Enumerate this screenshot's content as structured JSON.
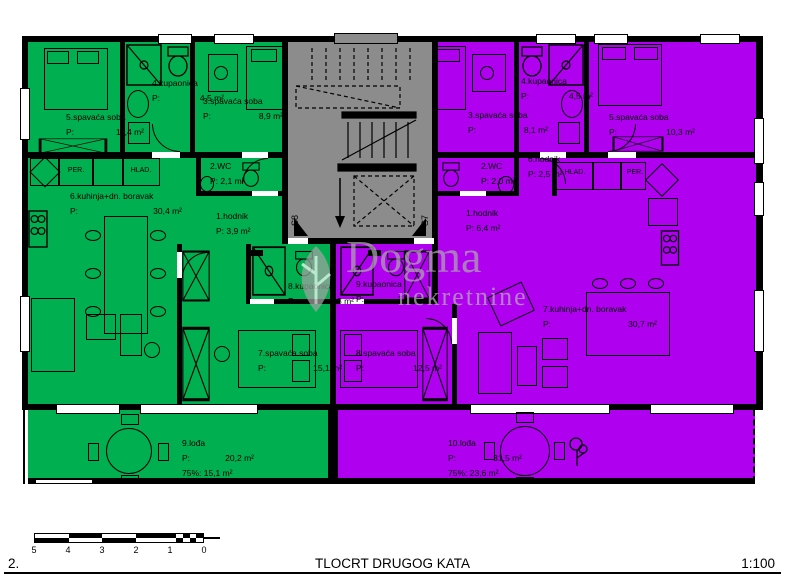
{
  "colors": {
    "green": "#00b050",
    "purple": "#b000f0",
    "gray": "#8c8c8c",
    "wall": "#000000"
  },
  "watermark": {
    "brand": "Dogma",
    "subtitle": "nekretnine"
  },
  "core": {
    "left_door": "S8",
    "right_door": "S7"
  },
  "left": {
    "bedroom5": {
      "name": "5.spavaća soba",
      "p": "P:",
      "area": "11,4 m²"
    },
    "bathroom4": {
      "name": "4.kupaonica",
      "p": "P:",
      "area": "4,5 m²"
    },
    "bedroom3": {
      "name": "3.spavaća soba",
      "p": "P:",
      "area": "8,9 m²"
    },
    "wc2": {
      "name": "2.WC",
      "area": "P: 2,1 m²"
    },
    "hodnik1": {
      "name": "1.hodnik",
      "area": "P: 3,9 m²"
    },
    "kitchen6": {
      "name": "6.kuhinja+dn. boravak",
      "p": "P:",
      "area": "30,4 m²"
    },
    "bedroom7": {
      "name": "7.spavaća soba",
      "p": "P:",
      "area": "15,1 m²"
    },
    "bathroom8": {
      "name": "8.kupaonica",
      "p": "P:",
      "area": "3,8 m²"
    },
    "loggia9": {
      "name": "9.lođa",
      "p": "P:",
      "area": "20,2 m²",
      "area75": "75%: 15,1 m²"
    },
    "washer": "PER.",
    "fridge": "HLAD."
  },
  "right": {
    "bedroom3": {
      "name": "3.spavaća soba",
      "p": "P:",
      "area": "8,1 m²"
    },
    "bathroom4": {
      "name": "4.kupaonica",
      "p": "P:",
      "area": "4,5 m²"
    },
    "bedroom5": {
      "name": "5.spavaća soba",
      "p": "P:",
      "area": "10,3 m²"
    },
    "wc2": {
      "name": "2.WC",
      "area": "P: 2,0 m²"
    },
    "hodnik6": {
      "name": "6.hodnik",
      "area": "P: 2,5 m²"
    },
    "hodnik1": {
      "name": "1.hodnik",
      "area": "P: 6,4 m²"
    },
    "kitchen7": {
      "name": "7.kuhinja+dn. boravak",
      "p": "P:",
      "area": "30,7 m²"
    },
    "bedroom8": {
      "name": "8.spavaća soba",
      "p": "P:",
      "area": "12,5 m²"
    },
    "bathroom9": {
      "name": "9.kupaonica",
      "p": "P:",
      "area": "3,8 m²"
    },
    "loggia10": {
      "name": "10.lođa",
      "p": "P:",
      "area": "31,5 m²",
      "area75": "75%: 23,6 m²"
    },
    "fridge": "HLAD.",
    "washer": "PER."
  },
  "scale_bar": {
    "ticks": [
      "5",
      "4",
      "3",
      "2",
      "1",
      "0"
    ]
  },
  "title_block": {
    "number": "2.",
    "title": "TLOCRT DRUGOG KATA",
    "scale": "1:100"
  }
}
